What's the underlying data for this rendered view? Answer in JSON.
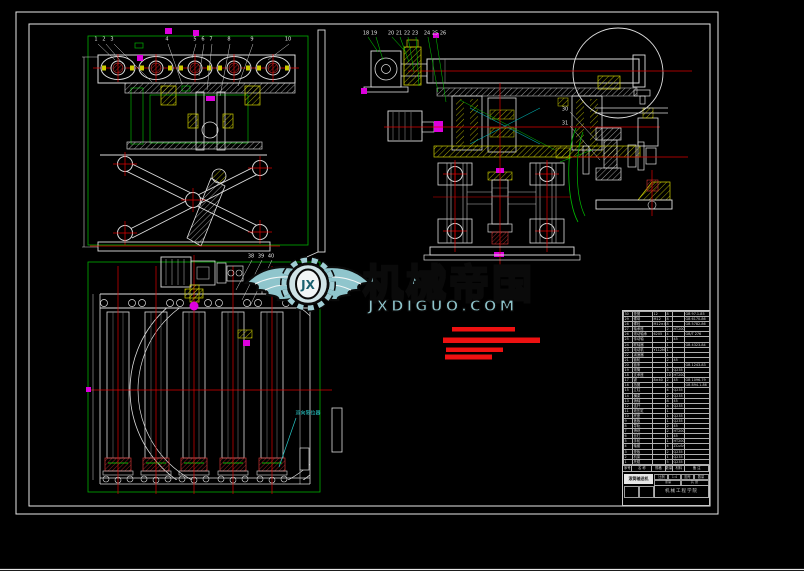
{
  "app": {
    "description": "CAD assembly drawing - roller conveyor with scissor lift mechanism"
  },
  "watermark": {
    "brand": "机械帝国",
    "site": "JXDIGUO.COM",
    "monogram": "JX",
    "teal": "#8fc5cc",
    "outline": "#0a0a0a"
  },
  "callout": {
    "text": "双向限位器"
  },
  "colors": {
    "line_white": "#e0e0e0",
    "centerline_red": "#d00000",
    "layer_green": "#00b000",
    "layer_yellow": "#cccc00",
    "layer_magenta": "#d000d0",
    "layer_cyan": "#00aaaa",
    "redacted_red": "#ee1111",
    "background": "#000000"
  },
  "balloons": [
    {
      "x": 96,
      "y": 40,
      "t": "1"
    },
    {
      "x": 104,
      "y": 40,
      "t": "2"
    },
    {
      "x": 112,
      "y": 40,
      "t": "3"
    },
    {
      "x": 167,
      "y": 40,
      "t": "4"
    },
    {
      "x": 195,
      "y": 40,
      "t": "5"
    },
    {
      "x": 203,
      "y": 40,
      "t": "6"
    },
    {
      "x": 211,
      "y": 40,
      "t": "7"
    },
    {
      "x": 229,
      "y": 40,
      "t": "8"
    },
    {
      "x": 252,
      "y": 40,
      "t": "9"
    },
    {
      "x": 288,
      "y": 40,
      "t": "10"
    },
    {
      "x": 366,
      "y": 34,
      "t": "18"
    },
    {
      "x": 374,
      "y": 34,
      "t": "19"
    },
    {
      "x": 391,
      "y": 34,
      "t": "20"
    },
    {
      "x": 399,
      "y": 34,
      "t": "21"
    },
    {
      "x": 407,
      "y": 34,
      "t": "22"
    },
    {
      "x": 415,
      "y": 34,
      "t": "23"
    },
    {
      "x": 427,
      "y": 34,
      "t": "24"
    },
    {
      "x": 435,
      "y": 34,
      "t": "25"
    },
    {
      "x": 443,
      "y": 34,
      "t": "26"
    },
    {
      "x": 565,
      "y": 110,
      "t": "30"
    },
    {
      "x": 565,
      "y": 124,
      "t": "31"
    },
    {
      "x": 251,
      "y": 257,
      "t": "38"
    },
    {
      "x": 261,
      "y": 257,
      "t": "39"
    },
    {
      "x": 271,
      "y": 257,
      "t": "40"
    }
  ],
  "bom": {
    "headers": [
      "序号",
      "名 称",
      "规格",
      "数量",
      "材料",
      "备 注"
    ],
    "rows": [
      {
        "no": "30",
        "name": "垫圈",
        "spec": "12",
        "qty": "8",
        "mat": "",
        "rem": "GB 97.1-85"
      },
      {
        "no": "29",
        "name": "螺母",
        "spec": "M12",
        "qty": "8",
        "mat": "",
        "rem": "GB 6170-86"
      },
      {
        "no": "28",
        "name": "螺栓",
        "spec": "M12×40",
        "qty": "8",
        "mat": "",
        "rem": "GB 5782-86"
      },
      {
        "no": "27",
        "name": "轴承座",
        "spec": "",
        "qty": "2",
        "mat": "HT200",
        "rem": ""
      },
      {
        "no": "26",
        "name": "滚动轴承",
        "spec": "6205",
        "qty": "4",
        "mat": "",
        "rem": "GB/T 276"
      },
      {
        "no": "25",
        "name": "传动轴",
        "spec": "",
        "qty": "1",
        "mat": "45",
        "rem": ""
      },
      {
        "no": "24",
        "name": "联轴器",
        "spec": "",
        "qty": "1",
        "mat": "",
        "rem": "GB 4323-84"
      },
      {
        "no": "23",
        "name": "电动机",
        "spec": "Y112M-4",
        "qty": "1",
        "mat": "",
        "rem": ""
      },
      {
        "no": "22",
        "name": "减速器",
        "spec": "",
        "qty": "1",
        "mat": "",
        "rem": ""
      },
      {
        "no": "21",
        "name": "链轮",
        "spec": "",
        "qty": "2",
        "mat": "45",
        "rem": ""
      },
      {
        "no": "20",
        "name": "链条",
        "spec": "",
        "qty": "1",
        "mat": "",
        "rem": "GB 1243-83"
      },
      {
        "no": "19",
        "name": "滚筒",
        "spec": "",
        "qty": "5",
        "mat": "Q235",
        "rem": ""
      },
      {
        "no": "18",
        "name": "支承座",
        "spec": "",
        "qty": "10",
        "mat": "HT200",
        "rem": ""
      },
      {
        "no": "17",
        "name": "键",
        "spec": "8×40",
        "qty": "2",
        "mat": "45",
        "rem": "GB 1096-79"
      },
      {
        "no": "16",
        "name": "挡圈",
        "spec": "",
        "qty": "4",
        "mat": "",
        "rem": "GB 894.1-86"
      },
      {
        "no": "15",
        "name": "立柱",
        "spec": "",
        "qty": "4",
        "mat": "Q235",
        "rem": ""
      },
      {
        "no": "14",
        "name": "横梁",
        "spec": "",
        "qty": "2",
        "mat": "Q235",
        "rem": ""
      },
      {
        "no": "13",
        "name": "销轴",
        "spec": "",
        "qty": "8",
        "mat": "45",
        "rem": ""
      },
      {
        "no": "12",
        "name": "连杆",
        "spec": "",
        "qty": "4",
        "mat": "Q235",
        "rem": ""
      },
      {
        "no": "11",
        "name": "液压缸",
        "spec": "",
        "qty": "1",
        "mat": "",
        "rem": ""
      },
      {
        "no": "10",
        "name": "底座",
        "spec": "",
        "qty": "1",
        "mat": "Q235",
        "rem": ""
      },
      {
        "no": "9",
        "name": "盖板",
        "spec": "",
        "qty": "1",
        "mat": "Q235",
        "rem": ""
      },
      {
        "no": "8",
        "name": "导轨",
        "spec": "",
        "qty": "2",
        "mat": "45",
        "rem": ""
      },
      {
        "no": "7",
        "name": "滑块",
        "spec": "",
        "qty": "2",
        "mat": "HT200",
        "rem": ""
      },
      {
        "no": "6",
        "name": "丝杠",
        "spec": "",
        "qty": "1",
        "mat": "45",
        "rem": ""
      },
      {
        "no": "5",
        "name": "手轮",
        "spec": "",
        "qty": "1",
        "mat": "HT200",
        "rem": ""
      },
      {
        "no": "4",
        "name": "轴套",
        "spec": "",
        "qty": "4",
        "mat": "ZCuSn10",
        "rem": ""
      },
      {
        "no": "3",
        "name": "垫板",
        "spec": "",
        "qty": "2",
        "mat": "Q235",
        "rem": ""
      },
      {
        "no": "2",
        "name": "机架",
        "spec": "",
        "qty": "1",
        "mat": "Q235",
        "rem": ""
      },
      {
        "no": "1",
        "name": "托辊",
        "spec": "",
        "qty": "5",
        "mat": "Q235",
        "rem": ""
      }
    ],
    "title_block": {
      "product": "滚筒输送机",
      "org": "机械工程学院",
      "labels": [
        "比例",
        "1:4",
        "图号",
        "数量",
        "重量",
        "共 张"
      ]
    }
  }
}
